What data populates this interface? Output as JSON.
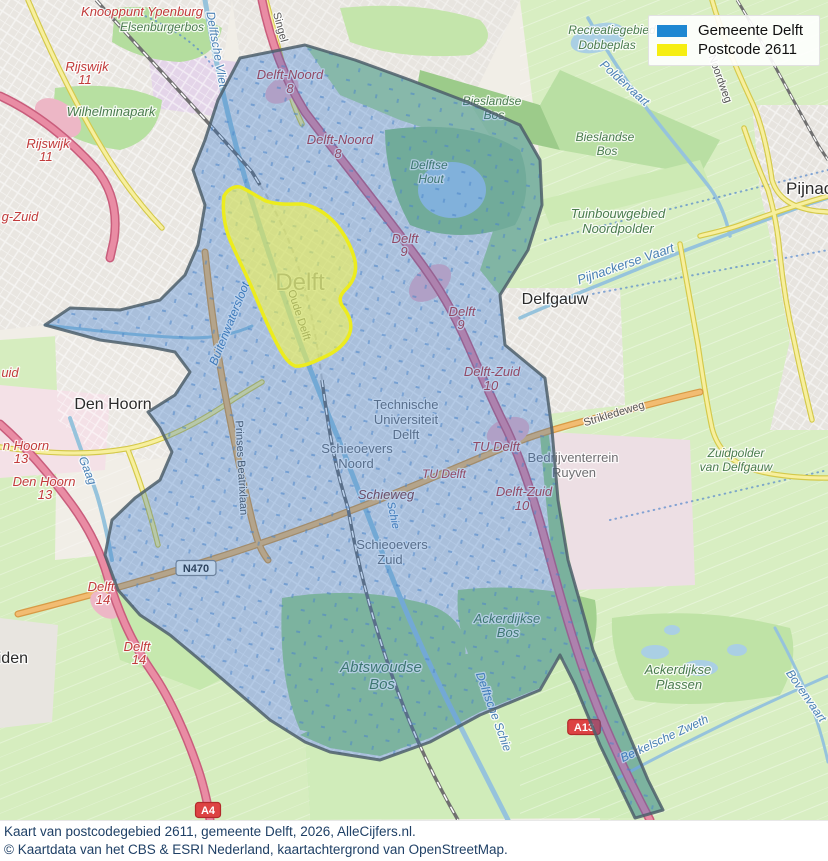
{
  "legend": {
    "items": [
      {
        "label": "Gemeente Delft",
        "color": "#1e88d2"
      },
      {
        "label": "Postcode 2611",
        "color": "#f6ee12"
      }
    ]
  },
  "caption": {
    "line1": "Kaart van postcodegebied 2611, gemeente Delft, 2026, AlleCijfers.nl.",
    "line2": "© Kaartdata van het CBS & ESRI Nederland, kaartachtergrond van OpenStreetMap."
  },
  "map": {
    "overlay_colors": {
      "gemeente_fill": "rgba(35,110,200,0.30)",
      "gemeente_border": "#4e5f6b",
      "postcode_fill": "rgba(250,250,70,0.55)",
      "postcode_border": "#ecec1e"
    },
    "badges": [
      {
        "text": "N470",
        "x": 196,
        "y": 568,
        "type": "ref"
      },
      {
        "text": "A13",
        "x": 584,
        "y": 727,
        "type": "motorway"
      },
      {
        "text": "A4",
        "x": 208,
        "y": 810,
        "type": "motorway"
      }
    ],
    "labels": [
      {
        "t": "Knooppunt Ypenburg",
        "x": 142,
        "y": 16,
        "c": "exit",
        "s": 13
      },
      {
        "t": "Elsenburgerbos",
        "x": 162,
        "y": 31,
        "c": "green",
        "s": 12
      },
      {
        "t": "Singel",
        "x": 277,
        "y": 28,
        "c": "road",
        "s": 11,
        "r": 75
      },
      {
        "t": "Rijswijk",
        "x": 87,
        "y": 71,
        "c": "exit",
        "s": 13
      },
      {
        "t": "11",
        "x": 85,
        "y": 84,
        "c": "exit",
        "s": 13
      },
      {
        "t": "Delft-Noord",
        "x": 290,
        "y": 79,
        "c": "exit",
        "s": 13
      },
      {
        "t": "8",
        "x": 290,
        "y": 93,
        "c": "exit",
        "s": 13
      },
      {
        "t": "Delftsche Vliet",
        "x": 213,
        "y": 50,
        "c": "water",
        "s": 12,
        "r": 80
      },
      {
        "t": "Wilhelminapark",
        "x": 111,
        "y": 116,
        "c": "green",
        "s": 13
      },
      {
        "t": "Rijswijk",
        "x": 48,
        "y": 148,
        "c": "exit",
        "s": 13
      },
      {
        "t": "11",
        "x": 46,
        "y": 161,
        "c": "exit",
        "s": 13
      },
      {
        "t": "Recreatiegebied",
        "x": 612,
        "y": 34,
        "c": "green",
        "s": 12
      },
      {
        "t": "Dobbeplas",
        "x": 607,
        "y": 49,
        "c": "green",
        "s": 12
      },
      {
        "t": "Poldervaart",
        "x": 622,
        "y": 86,
        "c": "water",
        "s": 12,
        "r": 42
      },
      {
        "t": "Noordweg",
        "x": 717,
        "y": 80,
        "c": "road",
        "s": 11,
        "r": 70
      },
      {
        "t": "Bieslandse",
        "x": 492,
        "y": 105,
        "c": "green",
        "s": 12
      },
      {
        "t": "Bos",
        "x": 494,
        "y": 119,
        "c": "green",
        "s": 12
      },
      {
        "t": "Delft-Noord",
        "x": 340,
        "y": 144,
        "c": "exit",
        "s": 13
      },
      {
        "t": "8",
        "x": 338,
        "y": 158,
        "c": "exit",
        "s": 13
      },
      {
        "t": "Bieslandse",
        "x": 605,
        "y": 141,
        "c": "green",
        "s": 12
      },
      {
        "t": "Bos",
        "x": 607,
        "y": 155,
        "c": "green",
        "s": 12
      },
      {
        "t": "Delftse",
        "x": 429,
        "y": 169,
        "c": "green",
        "s": 12
      },
      {
        "t": "Hout",
        "x": 431,
        "y": 183,
        "c": "green",
        "s": 12
      },
      {
        "t": "Pijnacker",
        "x": 786,
        "y": 194,
        "c": "place",
        "s": 17,
        "a": "start"
      },
      {
        "t": "g-Zuid",
        "x": 20,
        "y": 221,
        "c": "exit",
        "s": 13
      },
      {
        "t": "Tuinbouwgebied",
        "x": 618,
        "y": 218,
        "c": "green",
        "s": 13
      },
      {
        "t": "Noordpolder",
        "x": 618,
        "y": 233,
        "c": "green",
        "s": 13
      },
      {
        "t": "Delft",
        "x": 405,
        "y": 243,
        "c": "exit",
        "s": 13
      },
      {
        "t": "9",
        "x": 404,
        "y": 256,
        "c": "exit",
        "s": 13
      },
      {
        "t": "Delft",
        "x": 300,
        "y": 290,
        "c": "city",
        "s": 24
      },
      {
        "t": "Delfgauw",
        "x": 555,
        "y": 304,
        "c": "place",
        "s": 16
      },
      {
        "t": "Oude Delft",
        "x": 296,
        "y": 316,
        "c": "road",
        "s": 11,
        "r": 72
      },
      {
        "t": "Delft",
        "x": 462,
        "y": 316,
        "c": "exit",
        "s": 13
      },
      {
        "t": "9",
        "x": 461,
        "y": 329,
        "c": "exit",
        "s": 13
      },
      {
        "t": "Buitenwatersloot",
        "x": 233,
        "y": 325,
        "c": "water",
        "s": 12,
        "r": -68
      },
      {
        "t": "Pijnackerse Vaart",
        "x": 627,
        "y": 268,
        "c": "water",
        "s": 13,
        "r": -19
      },
      {
        "t": "uid",
        "x": 10,
        "y": 377,
        "c": "exit",
        "s": 13
      },
      {
        "t": "Delft-Zuid",
        "x": 492,
        "y": 376,
        "c": "exit",
        "s": 13
      },
      {
        "t": "10",
        "x": 491,
        "y": 390,
        "c": "exit",
        "s": 13
      },
      {
        "t": "Den Hoorn",
        "x": 113,
        "y": 409,
        "c": "place",
        "s": 16
      },
      {
        "t": "Technische",
        "x": 406,
        "y": 409,
        "c": "district",
        "s": 13
      },
      {
        "t": "Universiteit",
        "x": 406,
        "y": 424,
        "c": "district",
        "s": 13
      },
      {
        "t": "Delft",
        "x": 406,
        "y": 439,
        "c": "district",
        "s": 13
      },
      {
        "t": "Strikledeweg",
        "x": 615,
        "y": 417,
        "c": "road",
        "s": 11,
        "r": -17
      },
      {
        "t": "Zuidpolder",
        "x": 736,
        "y": 457,
        "c": "green",
        "s": 12
      },
      {
        "t": "van Delfgauw",
        "x": 736,
        "y": 471,
        "c": "green",
        "s": 12
      },
      {
        "t": "n Hoorn",
        "x": 26,
        "y": 450,
        "c": "exit",
        "s": 13
      },
      {
        "t": "13",
        "x": 21,
        "y": 463,
        "c": "exit",
        "s": 13
      },
      {
        "t": "TU Delft",
        "x": 496,
        "y": 451,
        "c": "exit",
        "s": 13
      },
      {
        "t": "Bedrijventerrein",
        "x": 573,
        "y": 462,
        "c": "district",
        "s": 13
      },
      {
        "t": "Ruyven",
        "x": 574,
        "y": 477,
        "c": "district",
        "s": 13
      },
      {
        "t": "Schieoevers",
        "x": 357,
        "y": 453,
        "c": "district",
        "s": 13
      },
      {
        "t": "Noord",
        "x": 356,
        "y": 468,
        "c": "district",
        "s": 13
      },
      {
        "t": "TU Delft",
        "x": 444,
        "y": 478,
        "c": "exit",
        "s": 12
      },
      {
        "t": "Den Hoorn",
        "x": 44,
        "y": 486,
        "c": "exit",
        "s": 13
      },
      {
        "t": "13",
        "x": 45,
        "y": 499,
        "c": "exit",
        "s": 13
      },
      {
        "t": "Gaag",
        "x": 84,
        "y": 472,
        "c": "water",
        "s": 12,
        "r": 68
      },
      {
        "t": "Prinses Beatrixlaan",
        "x": 238,
        "y": 468,
        "c": "road",
        "s": 11,
        "r": 87
      },
      {
        "t": "Schieweg",
        "x": 386,
        "y": 499,
        "c": "roadred",
        "s": 13
      },
      {
        "t": "Delft-Zuid",
        "x": 524,
        "y": 496,
        "c": "exit",
        "s": 13
      },
      {
        "t": "10",
        "x": 522,
        "y": 510,
        "c": "exit",
        "s": 13
      },
      {
        "t": "Schie",
        "x": 390,
        "y": 516,
        "c": "water",
        "s": 11,
        "r": 78
      },
      {
        "t": "Schieoevers",
        "x": 392,
        "y": 549,
        "c": "district",
        "s": 13
      },
      {
        "t": "Zuid",
        "x": 390,
        "y": 564,
        "c": "district",
        "s": 13
      },
      {
        "t": "Delft",
        "x": 101,
        "y": 591,
        "c": "exit",
        "s": 13
      },
      {
        "t": "14",
        "x": 103,
        "y": 604,
        "c": "exit",
        "s": 13
      },
      {
        "t": "Schipluiden",
        "x": 28,
        "y": 663,
        "c": "place",
        "s": 16,
        "a": "end"
      },
      {
        "t": "Delft",
        "x": 137,
        "y": 651,
        "c": "exit",
        "s": 13
      },
      {
        "t": "14",
        "x": 139,
        "y": 664,
        "c": "exit",
        "s": 13
      },
      {
        "t": "Ackerdijkse",
        "x": 507,
        "y": 623,
        "c": "green",
        "s": 13
      },
      {
        "t": "Bos",
        "x": 508,
        "y": 637,
        "c": "green",
        "s": 13
      },
      {
        "t": "Abtswoudse",
        "x": 381,
        "y": 672,
        "c": "green",
        "s": 15
      },
      {
        "t": "Bos",
        "x": 382,
        "y": 689,
        "c": "green",
        "s": 15
      },
      {
        "t": "Ackerdijkse",
        "x": 678,
        "y": 674,
        "c": "green",
        "s": 13
      },
      {
        "t": "Plassen",
        "x": 679,
        "y": 689,
        "c": "green",
        "s": 13
      },
      {
        "t": "Delftsche Schie",
        "x": 490,
        "y": 713,
        "c": "water",
        "s": 12,
        "r": 70
      },
      {
        "t": "Berkelsche Zweth",
        "x": 666,
        "y": 742,
        "c": "water",
        "s": 12,
        "r": -25
      },
      {
        "t": "Bovenvaart",
        "x": 803,
        "y": 698,
        "c": "water",
        "s": 12,
        "r": 55
      }
    ]
  }
}
